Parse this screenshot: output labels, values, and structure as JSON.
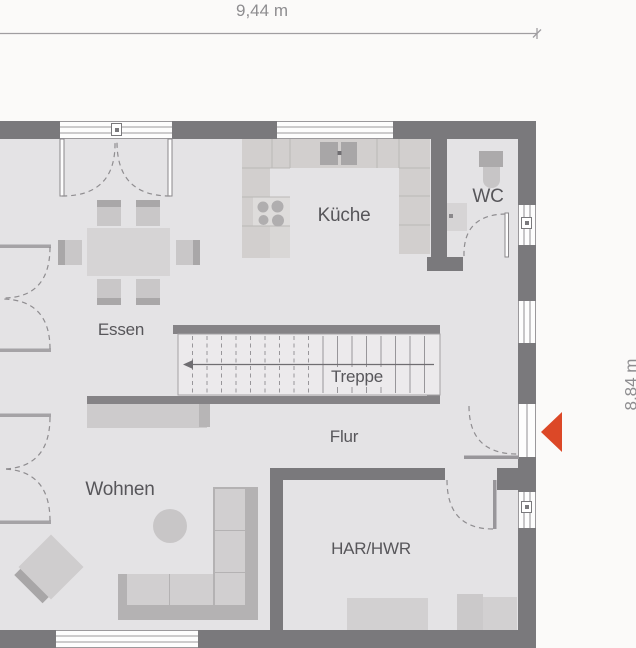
{
  "dimensions": {
    "width_label": "9,44 m",
    "height_label": "8,84 m"
  },
  "rooms": {
    "kitchen": "Küche",
    "wc": "WC",
    "dining": "Essen",
    "stairs": "Treppe",
    "hallway": "Flur",
    "living": "Wohnen",
    "utility": "HAR/HWR"
  },
  "stairs": {
    "label": "Treppe",
    "step_count": 18,
    "direction_arrow": "left"
  },
  "fixtures": {
    "kitchen": [
      "counter-u-shape",
      "double-sink",
      "cooktop-4-burners"
    ],
    "wc": [
      "toilet",
      "washbasin"
    ],
    "dining": [
      "table",
      "6-chairs"
    ],
    "living": [
      "corner-sofa",
      "round-side-table",
      "armchair",
      "sideboard"
    ],
    "utility": [
      "appliance",
      "appliance"
    ],
    "entrance": "orange-arrow-left"
  },
  "colors": {
    "wall": "#7a797c",
    "floor": "#e4e3e5",
    "outside": "#fbfaf9",
    "furn": "#d1cfd0",
    "furn_dark": "#a9a7a8",
    "accent": "#dc4827",
    "text": "#57565a",
    "dim_text": "#8e8d90",
    "line": "#9b999c",
    "stair_fill": "#eceaec"
  }
}
